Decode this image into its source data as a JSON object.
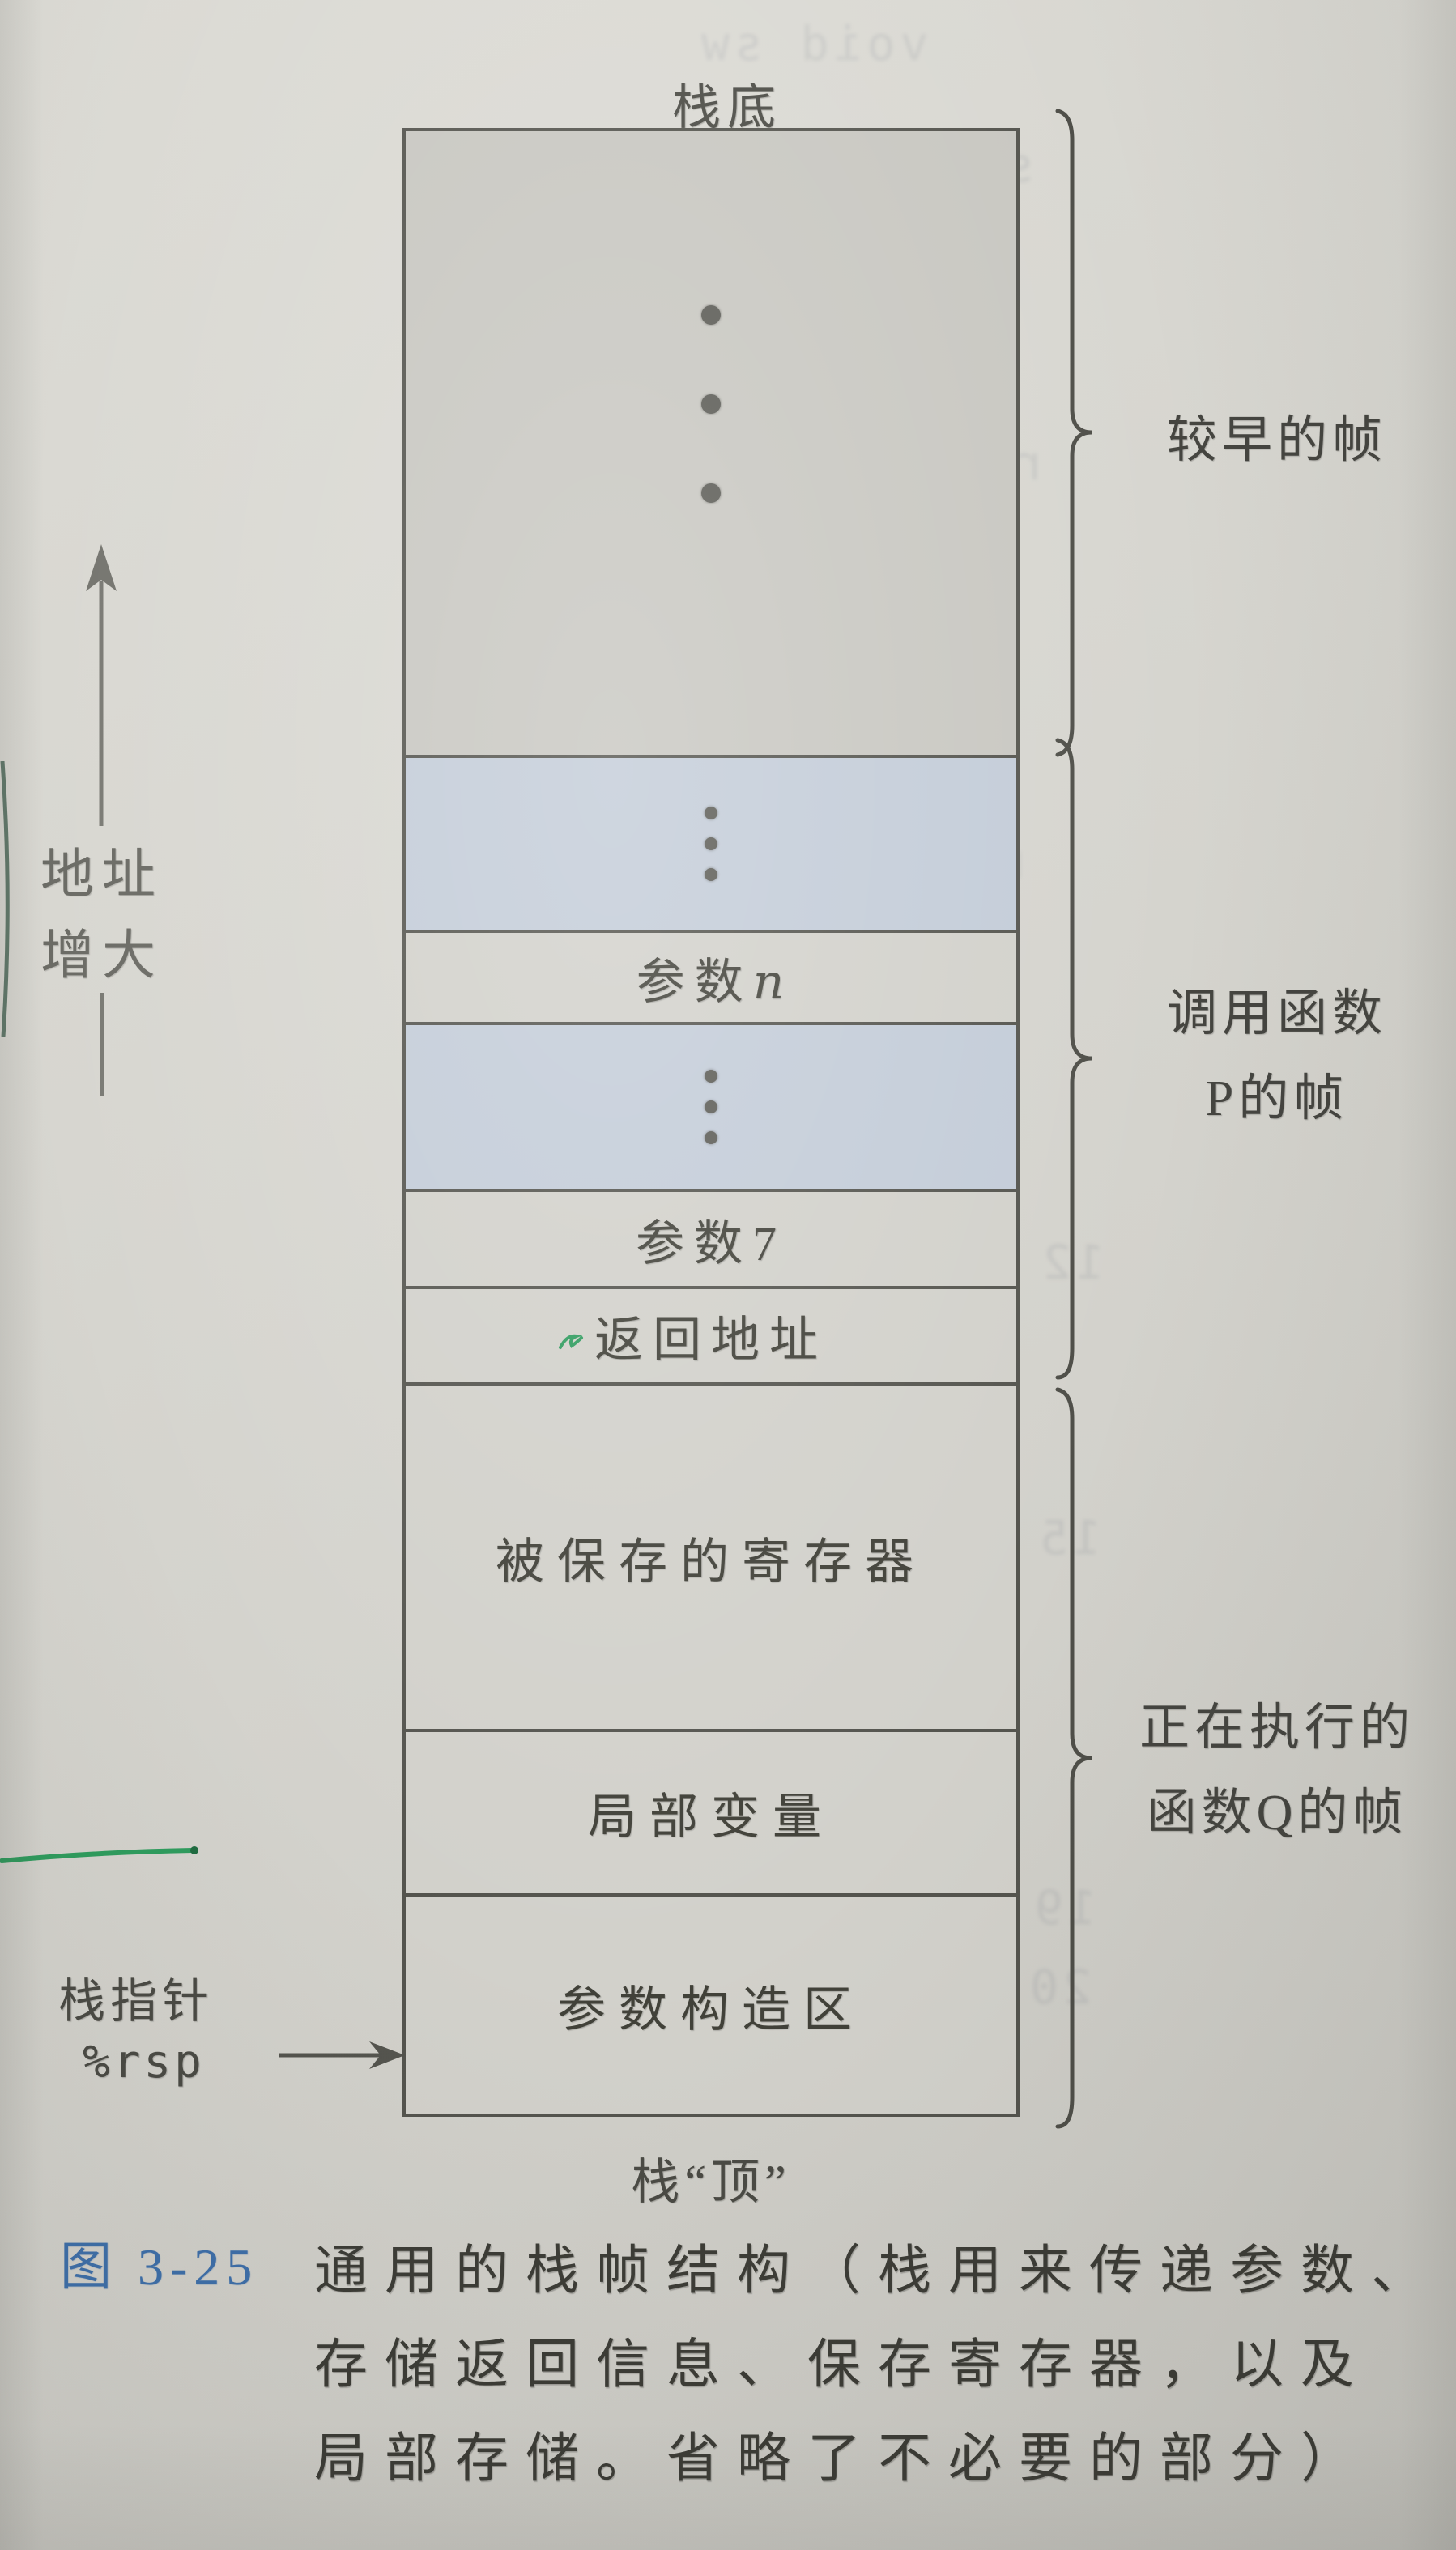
{
  "stack": {
    "bottom_label": "栈底",
    "top_label": "栈“顶”",
    "param_n_prefix": "参数",
    "param_n_var": "n",
    "param7": "参数7",
    "return_address": "返回地址",
    "saved_registers": "被保存的寄存器",
    "local_variables": "局部变量",
    "argument_build_area": "参数构造区"
  },
  "left": {
    "address_line1": "地址",
    "address_line2": "增大",
    "stack_pointer_label": "栈指针",
    "stack_pointer_register": "%rsp"
  },
  "braces": {
    "earlier_frames": "较早的帧",
    "caller_line1": "调用函数",
    "caller_line2": "P的帧",
    "current_line1": "正在执行的",
    "current_line2": "函数Q的帧"
  },
  "caption": {
    "figure_label": "图 3-25",
    "line1": "通用的栈帧结构（栈用来传递参数、",
    "line2": "存储返回信息、保存寄存器，以及",
    "line3": "局部存储。省略了不必要的部分）"
  },
  "colors": {
    "paper": "#d6d5cf",
    "gray_region": "#c8c7c1",
    "blue_region": "#c3ccd8",
    "row_light": "#d2d1cb",
    "line": "#54544e",
    "text": "#45453f",
    "caption_blue": "#3e6fa9",
    "pen_green": "#2f9c5e"
  },
  "bleed": {
    "fragments": [
      "void sw",
      "switcher",
      "cmpq",
      "js",
      "jmp",
      "section",
      "rodata",
      "movq",
      "movq %rsi",
      "leaq",
      "12",
      "15",
      "movq",
      "movq",
      "ret",
      "19",
      "20"
    ]
  }
}
